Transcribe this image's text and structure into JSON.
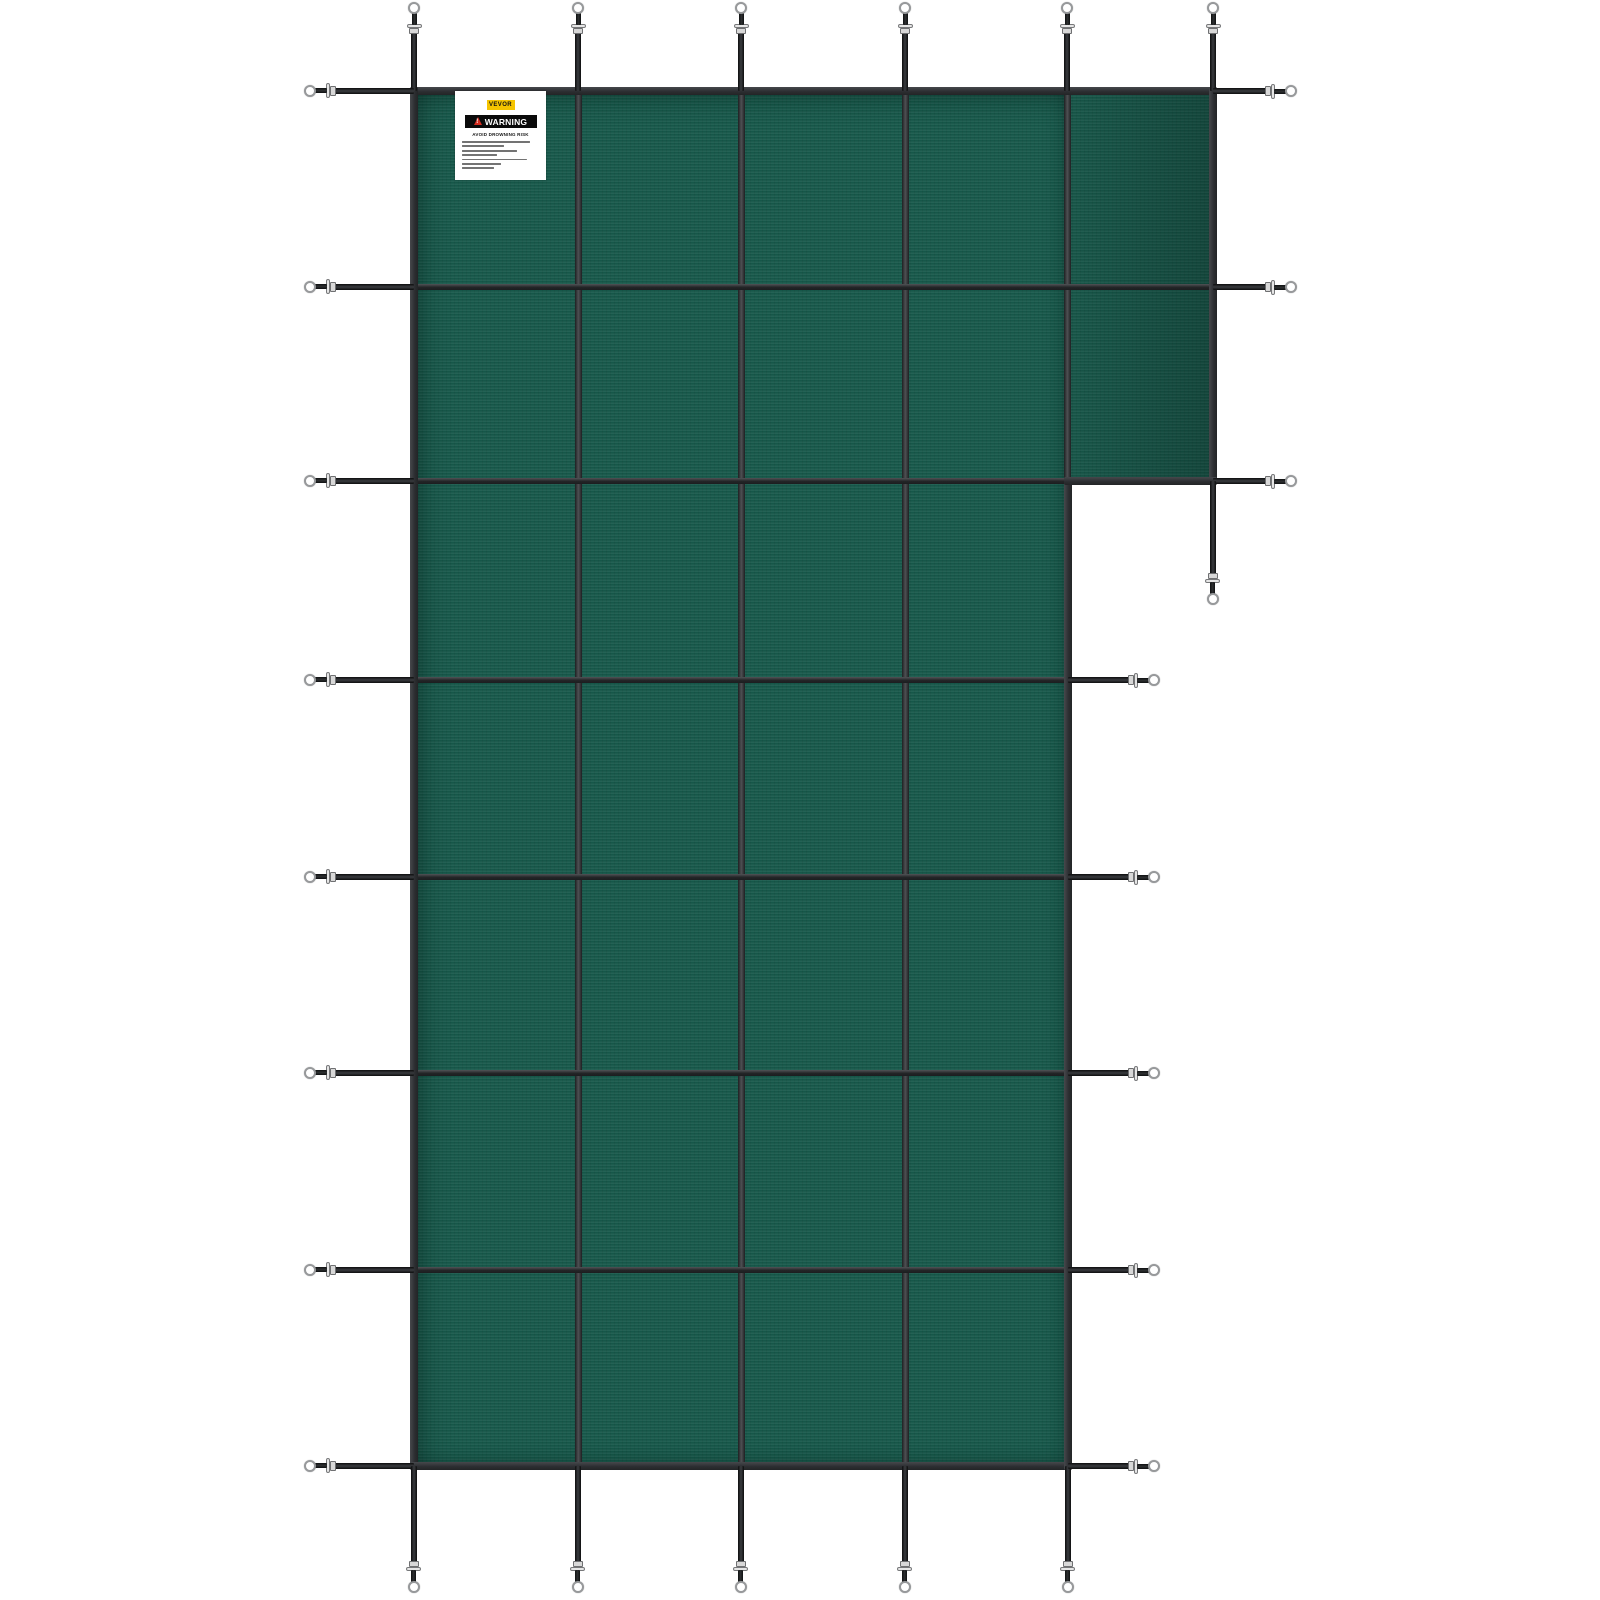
{
  "image": {
    "description": "Product photo of a VEVOR green mesh L-shaped inground pool safety cover with sewn grid straps, perimeter tension straps, metal buckles and spring rings, on a white background",
    "background_color": "#FFFFFF"
  },
  "cover": {
    "fabric_color": "#17594B",
    "fabric_shadow_color": "#0D4237",
    "grid_strap_dark": "#1E2022",
    "grid_strap_highlight": "#4E5053",
    "edge_binding_color": "#2B2D30",
    "perimeter_strap_color": "#1E2023",
    "hardware_metal_color": "#D8D8D8",
    "hardware_ring_rim_color": "#97999B",
    "shape": "L-shaped (rectangle with top-right step extension)",
    "grid_columns_main": 4,
    "grid_rows_main": 7,
    "extension_columns": 1,
    "extension_rows": 2,
    "strap_counts": {
      "top": 6,
      "left": 8,
      "bottom": 5,
      "right_main": 5,
      "right_extension": 3,
      "hanging": 1,
      "total": 28
    }
  },
  "warning_label": {
    "brand": "VEVOR",
    "brand_badge_bg": "#F5C400",
    "warning_word": "WARNING",
    "warning_banner_bg": "#0A0A0A",
    "warning_text_color": "#FFFFFF",
    "hazard_triangle_color": "#D42B1E",
    "headline": "AVOID DROWNING RISK",
    "label_bg": "#FFFFFF",
    "fine_print_line_widths_pct": [
      88,
      55,
      72,
      46,
      84,
      50,
      42
    ]
  }
}
